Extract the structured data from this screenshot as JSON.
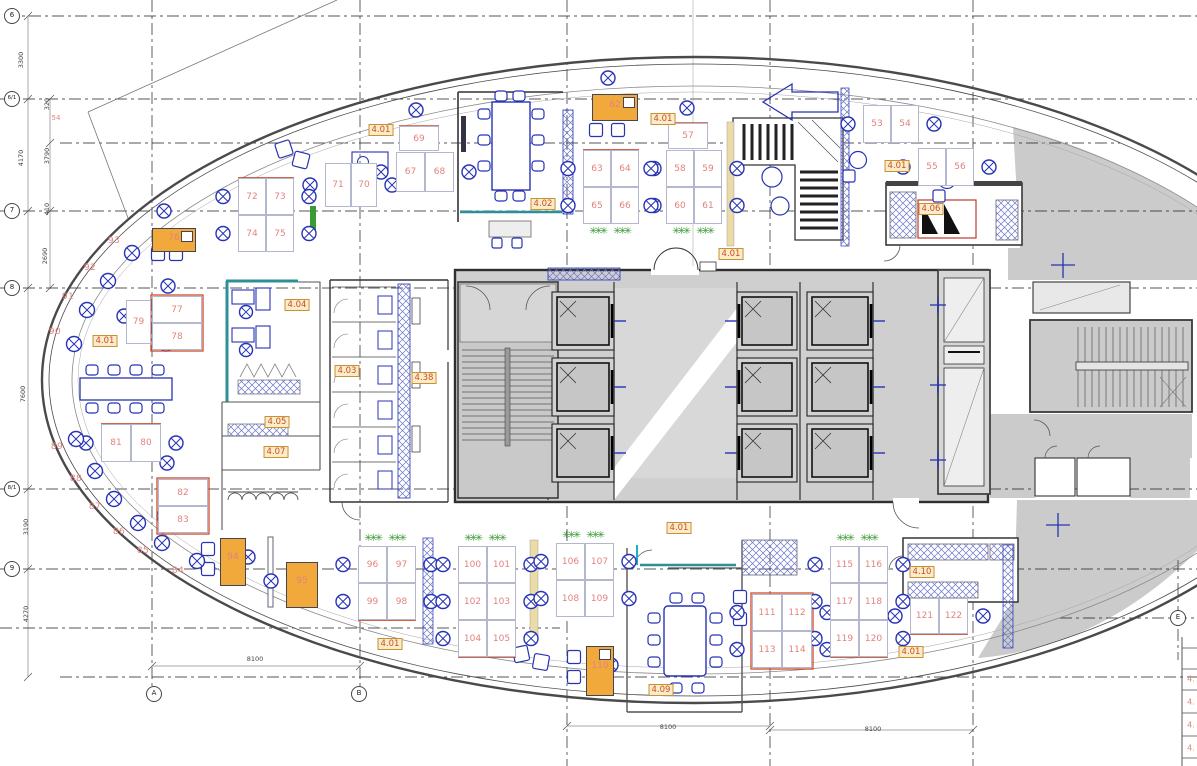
{
  "sheet": {
    "kind_label": "office floor plan"
  },
  "palette": {
    "outline": "#4a4a4a",
    "grid_line": "#1f1f1f",
    "furniture_blue": "#2733b5",
    "desk_edge": "#b4b8cf",
    "number_red": "#e2837f",
    "tag_text": "#cb4e1d",
    "tag_bg": "#faeccb",
    "tag_border": "#c89133",
    "orange_fill": "#f2a93b",
    "teal": "#2e8f96",
    "plant_green": "#3a9a33",
    "zone_gray": "#cbcbcb",
    "core_gray": "#cfcfcf",
    "red_accent": "#cc4b2e"
  },
  "grid": {
    "row_axes": [
      {
        "label": "6",
        "y": 16
      },
      {
        "label": "6/1",
        "y": 99
      },
      {
        "label": "7",
        "y": 211
      },
      {
        "label": "8",
        "y": 288
      },
      {
        "label": "8/1",
        "y": 489
      },
      {
        "label": "9",
        "y": 569
      }
    ],
    "col_axes": [
      {
        "label": "A",
        "x": 154,
        "y": 694
      },
      {
        "label": "B",
        "x": 359,
        "y": 694
      },
      {
        "label": "E",
        "x": 1178,
        "y": 618
      }
    ]
  },
  "dimensions": {
    "left_outer": [
      {
        "text": "3300",
        "x": 21,
        "y": 60
      },
      {
        "text": "4170",
        "x": 21,
        "y": 158
      },
      {
        "text": "7600",
        "x": 23,
        "y": 394
      },
      {
        "text": "3190",
        "x": 26,
        "y": 527
      },
      {
        "text": "4270",
        "x": 26,
        "y": 614
      }
    ],
    "left_inner": [
      {
        "text": "320",
        "x": 47,
        "y": 104
      },
      {
        "text": "3790",
        "x": 47,
        "y": 156
      },
      {
        "text": "410",
        "x": 47,
        "y": 209
      },
      {
        "text": "2690",
        "x": 45,
        "y": 256
      }
    ],
    "bottom": [
      {
        "text": "8100",
        "x": 255,
        "y": 659
      },
      {
        "text": "8100",
        "x": 668,
        "y": 727
      },
      {
        "text": "8100",
        "x": 873,
        "y": 729
      }
    ],
    "note": {
      "text": "54",
      "x": 56,
      "y": 118
    }
  },
  "room_tags": [
    {
      "label": "4.01",
      "x": 381,
      "y": 130
    },
    {
      "label": "4.01",
      "x": 663,
      "y": 119
    },
    {
      "label": "4.01",
      "x": 897,
      "y": 166
    },
    {
      "label": "4.02",
      "x": 543,
      "y": 204
    },
    {
      "label": "4.06",
      "x": 931,
      "y": 209
    },
    {
      "label": "4.01",
      "x": 731,
      "y": 254
    },
    {
      "label": "4.04",
      "x": 297,
      "y": 305
    },
    {
      "label": "4.01",
      "x": 105,
      "y": 341
    },
    {
      "label": "4.03",
      "x": 347,
      "y": 371
    },
    {
      "label": "4.38",
      "x": 424,
      "y": 378
    },
    {
      "label": "4.05",
      "x": 277,
      "y": 422
    },
    {
      "label": "4.07",
      "x": 276,
      "y": 452
    },
    {
      "label": "4.01",
      "x": 679,
      "y": 528
    },
    {
      "label": "4.01",
      "x": 390,
      "y": 644
    },
    {
      "label": "4.10",
      "x": 922,
      "y": 572
    },
    {
      "label": "4.01",
      "x": 911,
      "y": 652
    },
    {
      "label": "4.09",
      "x": 661,
      "y": 690
    }
  ],
  "workstations": {
    "clusters": [
      {
        "x": 583,
        "y": 150,
        "w": 56,
        "row_h": 37,
        "rows": [
          [
            "63",
            "64"
          ],
          [
            "65",
            "66"
          ]
        ],
        "plants": "below",
        "red_edge": "top"
      },
      {
        "x": 666,
        "y": 150,
        "w": 56,
        "row_h": 37,
        "rows": [
          [
            "58",
            "59"
          ],
          [
            "60",
            "61"
          ]
        ],
        "plants": "below",
        "top_desk": {
          "num": "57",
          "x": 668,
          "y": 123,
          "w": 40,
          "h": 26
        },
        "top_chair": [
          687,
          108
        ]
      },
      {
        "x": 863,
        "y": 105,
        "w": 56,
        "row_h": 38,
        "rows": [
          [
            "53",
            "54"
          ]
        ]
      },
      {
        "x": 918,
        "y": 148,
        "w": 56,
        "row_h": 38,
        "rows": [
          [
            "55",
            "56"
          ]
        ]
      },
      {
        "x": 396,
        "y": 152,
        "w": 58,
        "row_h": 40,
        "rows": [
          [
            "67",
            "68"
          ]
        ],
        "top_desk": {
          "num": "69",
          "x": 399,
          "y": 126,
          "w": 40,
          "h": 25
        },
        "top_chair": [
          416,
          110
        ]
      },
      {
        "x": 325,
        "y": 163,
        "w": 52,
        "row_h": 44,
        "rows": [
          [
            "71",
            "70"
          ]
        ]
      },
      {
        "x": 238,
        "y": 178,
        "w": 56,
        "row_h": 37,
        "rows": [
          [
            "72",
            "73"
          ],
          [
            "74",
            "75"
          ]
        ],
        "red_edge": "top"
      },
      {
        "x": 152,
        "y": 296,
        "w": 50,
        "row_h": 27,
        "rows": [
          [
            "77"
          ],
          [
            "78"
          ]
        ],
        "side_desk": {
          "num": "79",
          "x": 126,
          "y": 300,
          "w": 25,
          "h": 44
        },
        "chairs": [
          [
            168,
            286
          ],
          [
            166,
            344
          ],
          [
            124,
            316
          ]
        ],
        "red_edge": "box"
      },
      {
        "x": 101,
        "y": 424,
        "w": 60,
        "row_h": 38,
        "rows": [
          [
            "81",
            "80"
          ]
        ],
        "red_edge": "top"
      },
      {
        "x": 158,
        "y": 479,
        "w": 50,
        "row_h": 27,
        "rows": [
          [
            "82"
          ],
          [
            "83"
          ]
        ],
        "chairs": [
          [
            167,
            463
          ],
          [
            164,
            516
          ]
        ],
        "red_edge": "box"
      },
      {
        "x": 358,
        "y": 546,
        "w": 58,
        "row_h": 37,
        "rows": [
          [
            "96",
            "97"
          ],
          [
            "99",
            "98"
          ]
        ],
        "plants": "above",
        "red_edge": "bottom"
      },
      {
        "x": 458,
        "y": 546,
        "w": 58,
        "row_h": 37,
        "rows": [
          [
            "100",
            "101"
          ],
          [
            "102",
            "103"
          ],
          [
            "104",
            "105"
          ]
        ],
        "plants": "above",
        "red_edge": "bottom"
      },
      {
        "x": 556,
        "y": 543,
        "w": 58,
        "row_h": 37,
        "rows": [
          [
            "106",
            "107"
          ],
          [
            "108",
            "109"
          ]
        ],
        "plants": "above"
      },
      {
        "x": 752,
        "y": 594,
        "w": 60,
        "row_h": 37,
        "rows": [
          [
            "111",
            "112"
          ],
          [
            "113",
            "114"
          ]
        ],
        "red_edge": "box",
        "blue_mid": true
      },
      {
        "x": 830,
        "y": 546,
        "w": 58,
        "row_h": 37,
        "rows": [
          [
            "115",
            "116"
          ],
          [
            "117",
            "118"
          ],
          [
            "119",
            "120"
          ]
        ],
        "plants": "above",
        "red_edge": "bottom"
      },
      {
        "x": 910,
        "y": 598,
        "w": 58,
        "row_h": 36,
        "rows": [
          [
            "121",
            "122"
          ]
        ],
        "red_edge": "bottom"
      }
    ],
    "orange_desks": [
      {
        "num": "62",
        "x": 592,
        "y": 94,
        "w": 46,
        "h": 27,
        "chair": [
          608,
          78
        ],
        "notch": true
      },
      {
        "num": "76",
        "x": 152,
        "y": 228,
        "w": 44,
        "h": 24,
        "chair": [
          164,
          211
        ],
        "notch": true
      },
      {
        "num": "94",
        "x": 220,
        "y": 538,
        "w": 26,
        "h": 48,
        "chair": [
          248,
          557
        ]
      },
      {
        "num": "95",
        "x": 286,
        "y": 562,
        "w": 32,
        "h": 46,
        "chair": [
          271,
          581
        ]
      },
      {
        "num": "110",
        "x": 586,
        "y": 646,
        "w": 28,
        "h": 50,
        "chair": [
          611,
          665
        ],
        "notch": true
      }
    ],
    "perimeter_seats": [
      {
        "num": "93",
        "nx": 114,
        "ny": 241,
        "cx": 132,
        "cy": 253
      },
      {
        "num": "92",
        "nx": 90,
        "ny": 268,
        "cx": 108,
        "cy": 281
      },
      {
        "num": "91",
        "nx": 68,
        "ny": 297,
        "cx": 87,
        "cy": 310
      },
      {
        "num": "90",
        "nx": 55,
        "ny": 332,
        "cx": 74,
        "cy": 344
      },
      {
        "num": "89",
        "nx": 57,
        "ny": 447,
        "cx": 76,
        "cy": 439
      },
      {
        "num": "88",
        "nx": 76,
        "ny": 479,
        "cx": 95,
        "cy": 471
      },
      {
        "num": "87",
        "nx": 95,
        "ny": 507,
        "cx": 114,
        "cy": 499
      },
      {
        "num": "86",
        "nx": 119,
        "ny": 532,
        "cx": 138,
        "cy": 523
      },
      {
        "num": "85",
        "nx": 143,
        "ny": 551,
        "cx": 162,
        "cy": 543
      },
      {
        "num": "84",
        "nx": 178,
        "ny": 571,
        "cx": 197,
        "cy": 561
      }
    ]
  },
  "legend_strip": {
    "rows": [
      "4.",
      "4.",
      "4.",
      "4."
    ]
  }
}
